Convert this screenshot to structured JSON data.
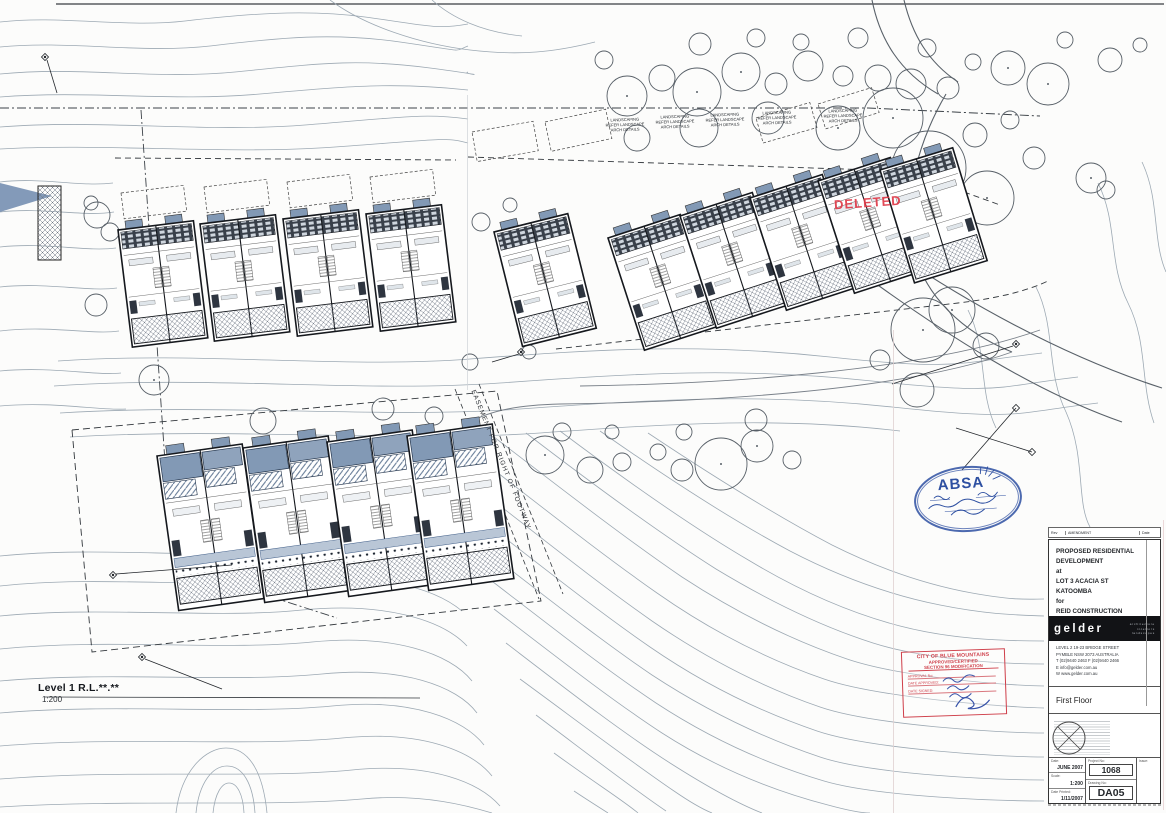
{
  "plan": {
    "level_label": "Level 1 R.L.**.**",
    "scale_label": "1:200",
    "deleted_label": "DELETED",
    "easement_label": "EASEMENT FOR RIGHT OF FOOTWAY",
    "landscape_note": {
      "line1": "LANDSCAPING",
      "line2": "REFER LANDSCAPE",
      "line3": "ARCH DETAILS"
    }
  },
  "stamps": {
    "absa": {
      "name": "ABSA"
    },
    "council": {
      "line1": "CITY OF BLUE MOUNTAINS",
      "line2": "APPROVED/CERTIFIED",
      "line3": "SECTION 96 MODIFICATION",
      "approval_label": "APPROVAL No:",
      "approved_label": "DATE APPROVED:",
      "signed_label": "DATE SIGNED:"
    }
  },
  "title_block": {
    "revision": {
      "col1": "Rev",
      "col2": "AMENDMENT",
      "col3": "Date"
    },
    "project": {
      "line1": "PROPOSED RESIDENTIAL",
      "line2": "DEVELOPMENT",
      "line3": "at",
      "line4": "LOT 3 ACACIA ST",
      "line5": "KATOOMBA",
      "line6": "for",
      "line7": "REID CONSTRUCTION"
    },
    "firm": {
      "logo": "gelder",
      "tag1": "architecture",
      "tag2": "interiors",
      "tag3": "landscapes"
    },
    "address": {
      "line1": "LEVEL 2   19-23 BRIDGE STREET",
      "line2": "PYMBLE NSW 2073 AUSTRALIA",
      "line3": "T (02)9440 2463   F (02)9440 2466",
      "line4": "E info@gelder.com.au",
      "line5": "W www.gelder.com.au"
    },
    "drawing_title": "First Floor",
    "fields": {
      "date_label": "Date:",
      "date_value": "JUNE 2007",
      "scale_label": "Scale:",
      "scale_value": "1:200",
      "printed_label": "Date Printed:",
      "printed_value": "1/11/2007",
      "project_label": "Project No:",
      "project_value": "1068",
      "drawing_label": "Drawing No:",
      "drawing_value": "DA05",
      "issue_label": "Issue:"
    }
  },
  "colors": {
    "contour": "#98a5b0",
    "building_blue": "#8299b5",
    "stamp_red": "#cf3f4a",
    "stamp_blue": "#2d4fa1"
  }
}
